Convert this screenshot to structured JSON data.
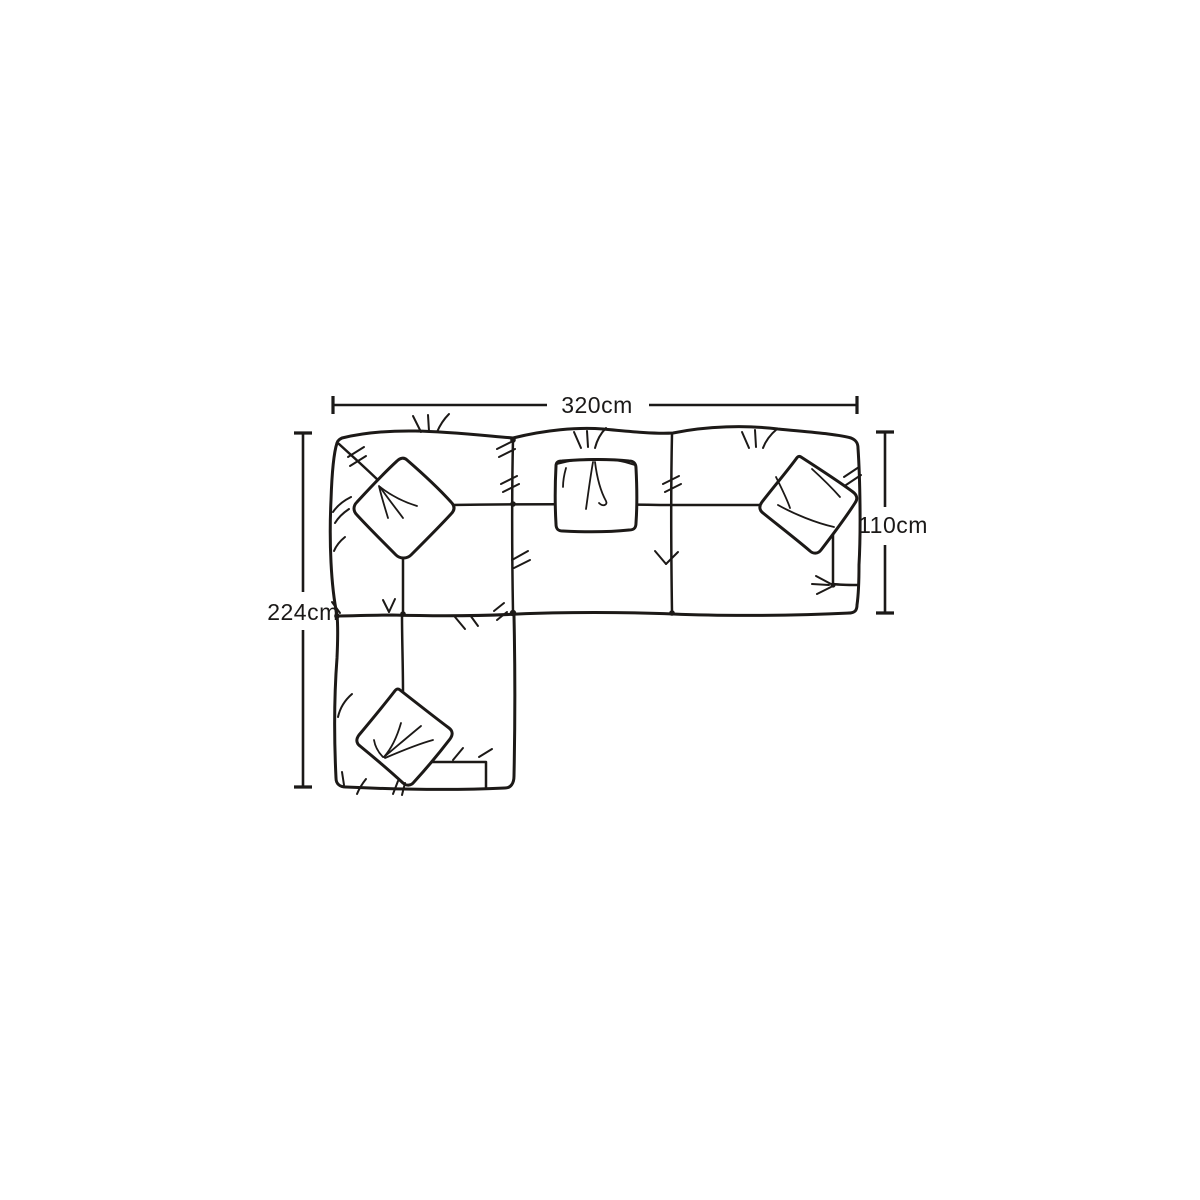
{
  "diagram": {
    "labels": {
      "overall_width": "320cm",
      "overall_depth": "224cm",
      "sofa_depth": "110cm"
    },
    "colors": {
      "ink": "#1c1917",
      "background": "#ffffff"
    }
  }
}
